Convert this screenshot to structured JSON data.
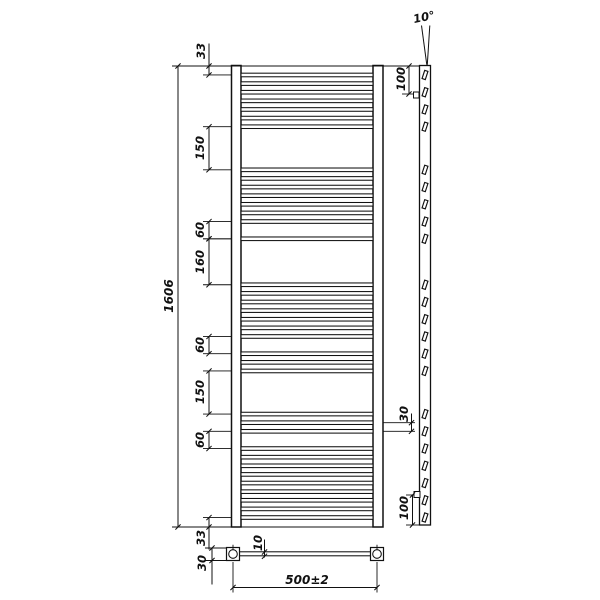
{
  "drawing_type": "technical-drawing",
  "subject": "ladder towel radiator - front view, side view and bottom view with dimensions",
  "units": "mm",
  "colors": {
    "line": "#111111",
    "background": "#ffffff"
  },
  "front_view": {
    "overall_height": {
      "label": "1606",
      "value": 1606
    },
    "top_margin": {
      "label": "33",
      "value": 33
    },
    "bottom_margin": {
      "label": "33",
      "value": 33
    },
    "left_gap_dims": [
      {
        "label": "150",
        "value": 150,
        "from_mm": 213,
        "to_mm": 363
      },
      {
        "label": "60",
        "value": 60,
        "from_mm": 543,
        "to_mm": 603
      },
      {
        "label": "160",
        "value": 160,
        "from_mm": 603,
        "to_mm": 763
      },
      {
        "label": "60",
        "value": 60,
        "from_mm": 943,
        "to_mm": 1003
      },
      {
        "label": "150",
        "value": 150,
        "from_mm": 1063,
        "to_mm": 1213
      },
      {
        "label": "60",
        "value": 60,
        "from_mm": 1273,
        "to_mm": 1333
      }
    ],
    "rung_pitch_dim": {
      "label": "30",
      "value": 30,
      "from_mm": 1243,
      "to_mm": 1273
    },
    "rung_positions_mm": [
      33,
      63,
      93,
      123,
      153,
      183,
      213,
      363,
      393,
      423,
      453,
      483,
      513,
      543,
      603,
      763,
      793,
      823,
      853,
      883,
      913,
      943,
      1003,
      1033,
      1063,
      1213,
      1243,
      1273,
      1333,
      1363,
      1393,
      1423,
      1453,
      1483,
      1513,
      1543,
      1573
    ]
  },
  "side_view": {
    "tilt_angle": {
      "label": "10°",
      "value": 10
    },
    "top_mount_offset": {
      "label": "100",
      "value": 100
    },
    "bottom_mount_offset": {
      "label": "100",
      "value": 100
    },
    "mark_positions_mm": [
      33,
      93,
      153,
      213,
      363,
      423,
      483,
      543,
      603,
      763,
      823,
      883,
      943,
      1003,
      1063,
      1213,
      1273,
      1333,
      1393,
      1453,
      1513,
      1573
    ]
  },
  "bottom_view": {
    "connection_width": {
      "label": "500±2",
      "value": "500±2"
    },
    "end_fitting_dim": {
      "label": "30",
      "value": 30
    },
    "tube_offset_dim": {
      "label": "10",
      "value": 10
    }
  }
}
